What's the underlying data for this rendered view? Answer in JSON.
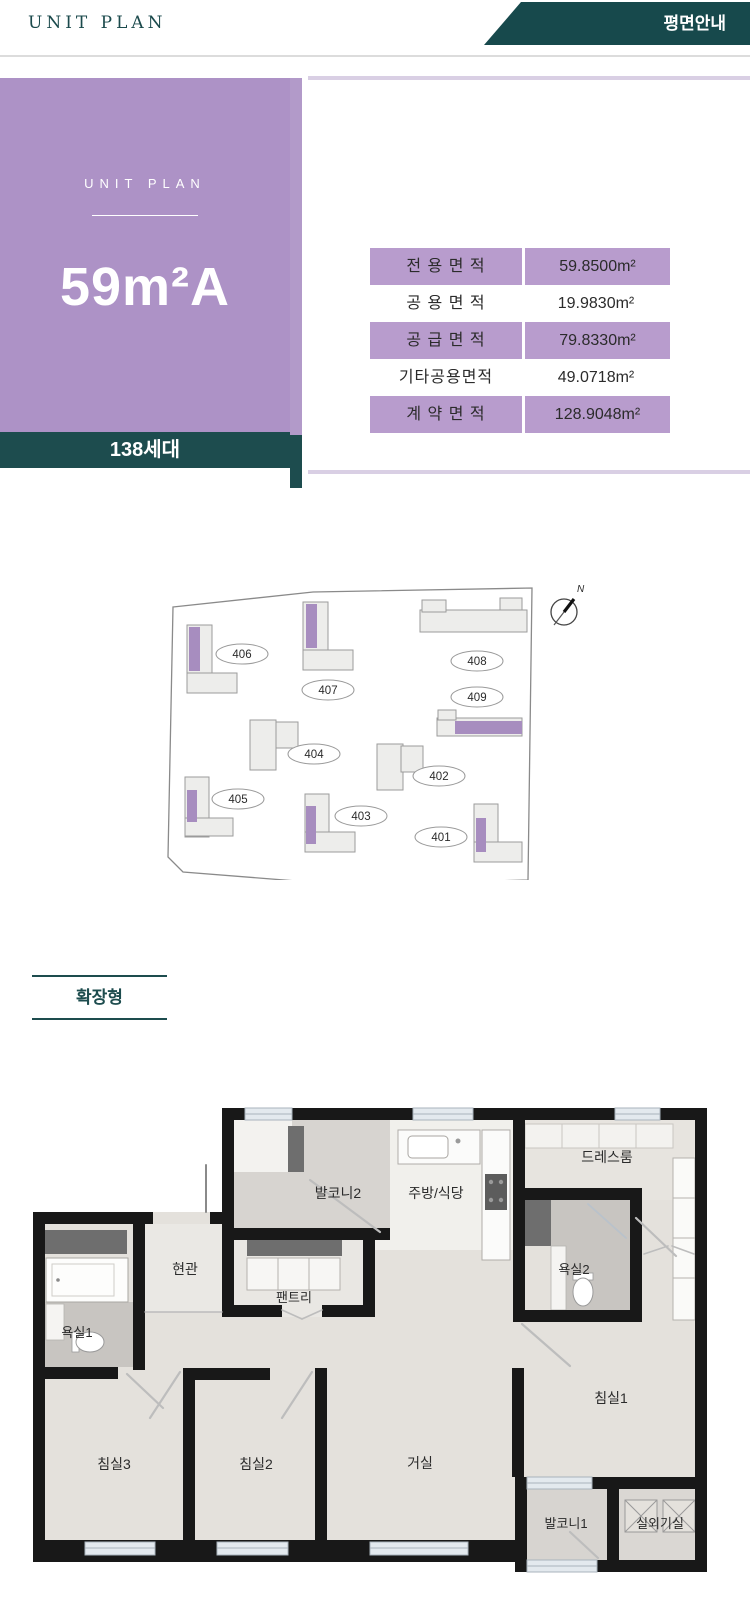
{
  "colors": {
    "teal": "#17494c",
    "card_purple": "#ad92c6",
    "table_purple": "#b89ccd",
    "accent_line": "#d9cfe4",
    "site_highlight_purple": "#a78dbf",
    "wall_black": "#181818"
  },
  "header": {
    "brand": "UNIT PLAN",
    "banner": "평면안내"
  },
  "unit_card": {
    "eyebrow": "UNIT PLAN",
    "unit_name": "59m²A",
    "units_badge": "138세대"
  },
  "area_table": {
    "rows": [
      {
        "label": "전 용 면 적",
        "value": "59.8500m²"
      },
      {
        "label": "공 용 면 적",
        "value": "19.9830m²"
      },
      {
        "label": "공 급 면 적",
        "value": "79.8330m²"
      },
      {
        "label": "기타공용면적",
        "value": "49.0718m²"
      },
      {
        "label": "계 약 면 적",
        "value": "128.9048m²"
      }
    ]
  },
  "site_plan": {
    "compass_label": "N",
    "buildings": [
      {
        "no": "401",
        "highlighted": true
      },
      {
        "no": "402",
        "highlighted": false
      },
      {
        "no": "403",
        "highlighted": true
      },
      {
        "no": "404",
        "highlighted": false
      },
      {
        "no": "405",
        "highlighted": true
      },
      {
        "no": "406",
        "highlighted": true
      },
      {
        "no": "407",
        "highlighted": true
      },
      {
        "no": "408",
        "highlighted": false
      },
      {
        "no": "409",
        "highlighted": true
      }
    ]
  },
  "section": {
    "label": "확장형"
  },
  "floor_plan": {
    "rooms": [
      {
        "label": "발코니2"
      },
      {
        "label": "주방/식당"
      },
      {
        "label": "드레스룸"
      },
      {
        "label": "현관"
      },
      {
        "label": "팬트리"
      },
      {
        "label": "욕실2"
      },
      {
        "label": "욕실1"
      },
      {
        "label": "침실1"
      },
      {
        "label": "침실3"
      },
      {
        "label": "침실2"
      },
      {
        "label": "거실"
      },
      {
        "label": "발코니1"
      },
      {
        "label": "실외기실"
      }
    ]
  }
}
